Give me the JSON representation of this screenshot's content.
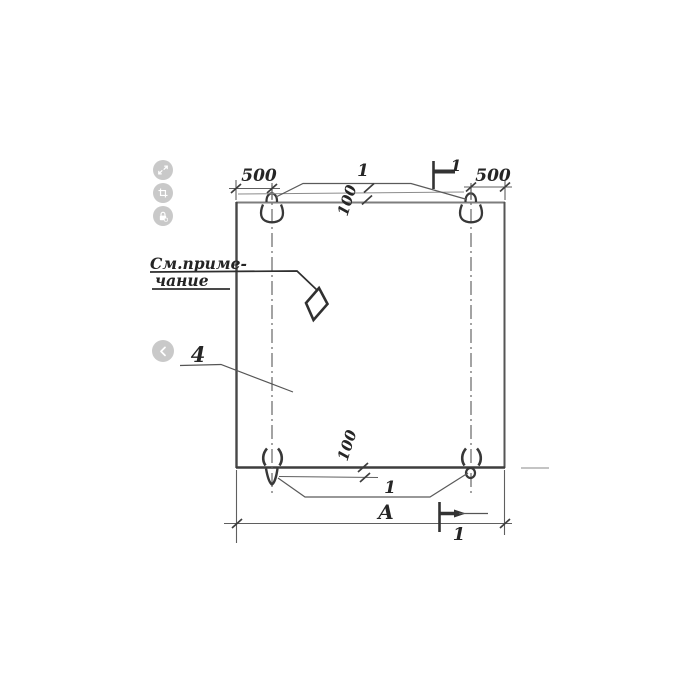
{
  "viewer": {
    "buttons": [
      {
        "id": "expand",
        "icon": "expand-icon"
      },
      {
        "id": "crop",
        "icon": "crop-icon"
      },
      {
        "id": "lock",
        "icon": "lock-icon"
      },
      {
        "id": "prev",
        "icon": "chevron-left-icon"
      }
    ]
  },
  "drawing": {
    "dims": {
      "left_offset": "500",
      "right_offset": "500",
      "edge_top": "100",
      "edge_bottom": "100",
      "overall": "А"
    },
    "callouts": {
      "loops_top": "1",
      "loops_bottom": "1",
      "item": "4"
    },
    "sections": {
      "top": "1",
      "bottom": "1"
    },
    "note": {
      "line1": "См.приме-",
      "line2": "чание"
    }
  }
}
